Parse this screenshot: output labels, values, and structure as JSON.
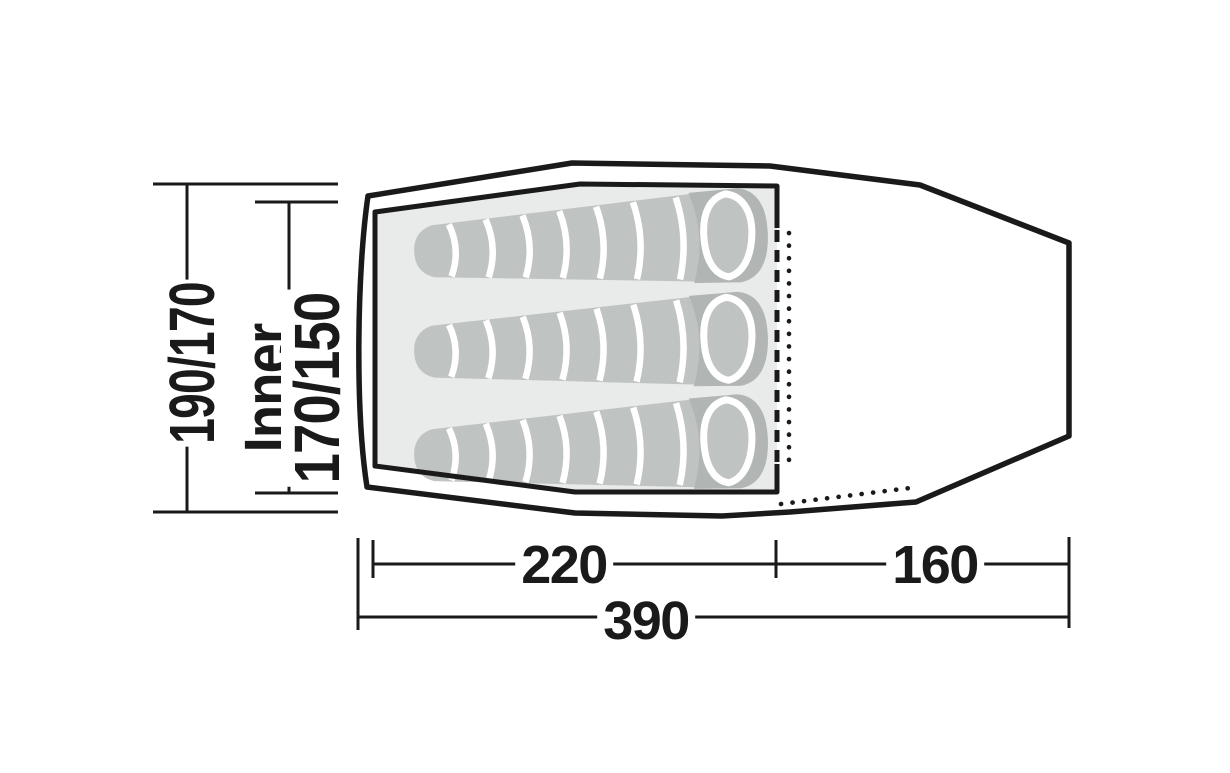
{
  "diagram": {
    "title": "tent-floorplan-top-view",
    "sleeping_bag_count": 3,
    "labels": {
      "outer_height": "190/170",
      "inner_height_line1": "Inner",
      "inner_height_line2": "170/150",
      "inner_length": "220",
      "porch_length": "160",
      "total_length": "390"
    },
    "dimensions": [
      {
        "name": "outer-height",
        "value": "190/170",
        "orientation": "vertical"
      },
      {
        "name": "inner-height",
        "value": "Inner 170/150",
        "orientation": "vertical"
      },
      {
        "name": "inner-length",
        "value": "220",
        "orientation": "horizontal"
      },
      {
        "name": "porch-length",
        "value": "160",
        "orientation": "horizontal"
      },
      {
        "name": "total-length",
        "value": "390",
        "orientation": "horizontal"
      }
    ],
    "colors": {
      "ink": "#1a1a1a",
      "bg": "#ffffff",
      "floor": "#e9ebea",
      "bag": "#bfc3c1",
      "bag_shadow": "#b1b5b3",
      "divider": "#ffffff"
    }
  }
}
